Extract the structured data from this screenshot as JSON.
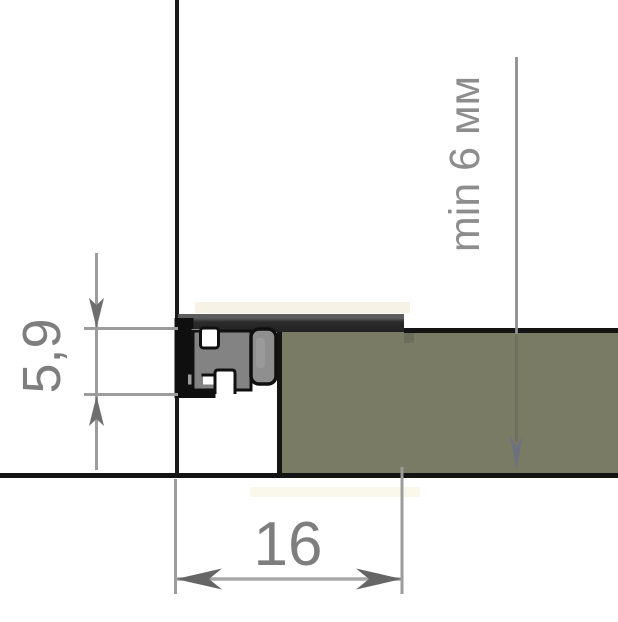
{
  "drawing": {
    "dimensions": {
      "profile_height": {
        "label": "5,9"
      },
      "groove_width": {
        "label": "16"
      },
      "panel_min_thickness": {
        "label": "min 6 мм"
      }
    },
    "colors": {
      "panel_olive": "#797b65",
      "outline_black": "#141414",
      "dimension_line_gray": "#9c9c9c",
      "dimension_text_gray": "#7e7e7e",
      "annotation_text_gray": "#8d8d8d",
      "profile_body_gray": "#838383",
      "gasket_gray": "#8f8f8f",
      "carrier_bar_dark": "#282828",
      "arrow_gray": "#6e6e6e",
      "panel_arrow_slate": "#6b7180"
    }
  }
}
